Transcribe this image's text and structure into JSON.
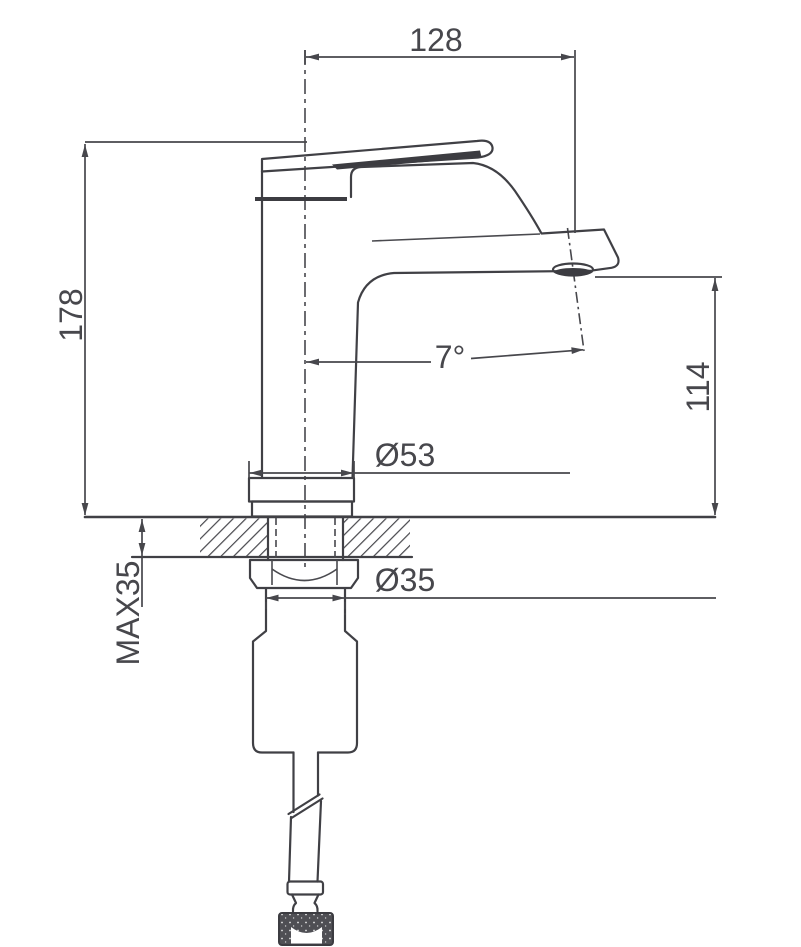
{
  "drawing": {
    "background": "#ffffff",
    "line_color": "#404045",
    "dimension_color": "#47474c",
    "labels": {
      "spout_reach": "128",
      "overall_height": "178",
      "outlet_height": "114",
      "outlet_angle": "7°",
      "base_diameter": "Ø53",
      "shank_diameter": "Ø35",
      "max_counter_thickness": "MAX35"
    }
  }
}
